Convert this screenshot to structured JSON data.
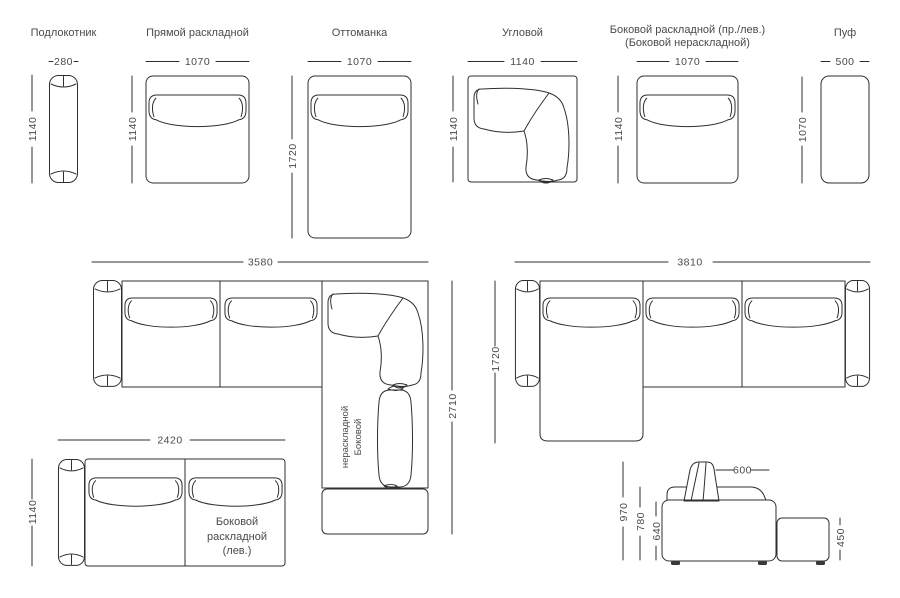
{
  "modules": [
    {
      "label": "Подлокотник",
      "width": "280",
      "height": "1140"
    },
    {
      "label": "Прямой раскладной",
      "width": "1070",
      "height": "1140"
    },
    {
      "label": "Оттоманка",
      "width": "1070",
      "height": "1720"
    },
    {
      "label": "Угловой",
      "width": "1140",
      "height": "1140"
    },
    {
      "label": "Боковой раскладной (пр./лев.)",
      "label_line2": "(Боковой нераскладной)",
      "width": "1070",
      "height": "1140"
    },
    {
      "label": "Пуф",
      "width": "500",
      "height": "1070"
    }
  ],
  "corner_sofa": {
    "width": "3580",
    "depth": "2710",
    "leg_label_line1": "Боковой",
    "leg_label_line2": "нераскладной"
  },
  "straight_sofa": {
    "width": "2420",
    "depth": "1140",
    "label_line1": "Боковой",
    "label_line2": "раскладной",
    "label_line3": "(лев.)"
  },
  "ottoman_sofa": {
    "width": "3810",
    "depth": "1720"
  },
  "side_view": {
    "backrest_width": "600",
    "total_height": "970",
    "backrest_height": "780",
    "armrest_height": "640",
    "pouf_height": "450"
  }
}
